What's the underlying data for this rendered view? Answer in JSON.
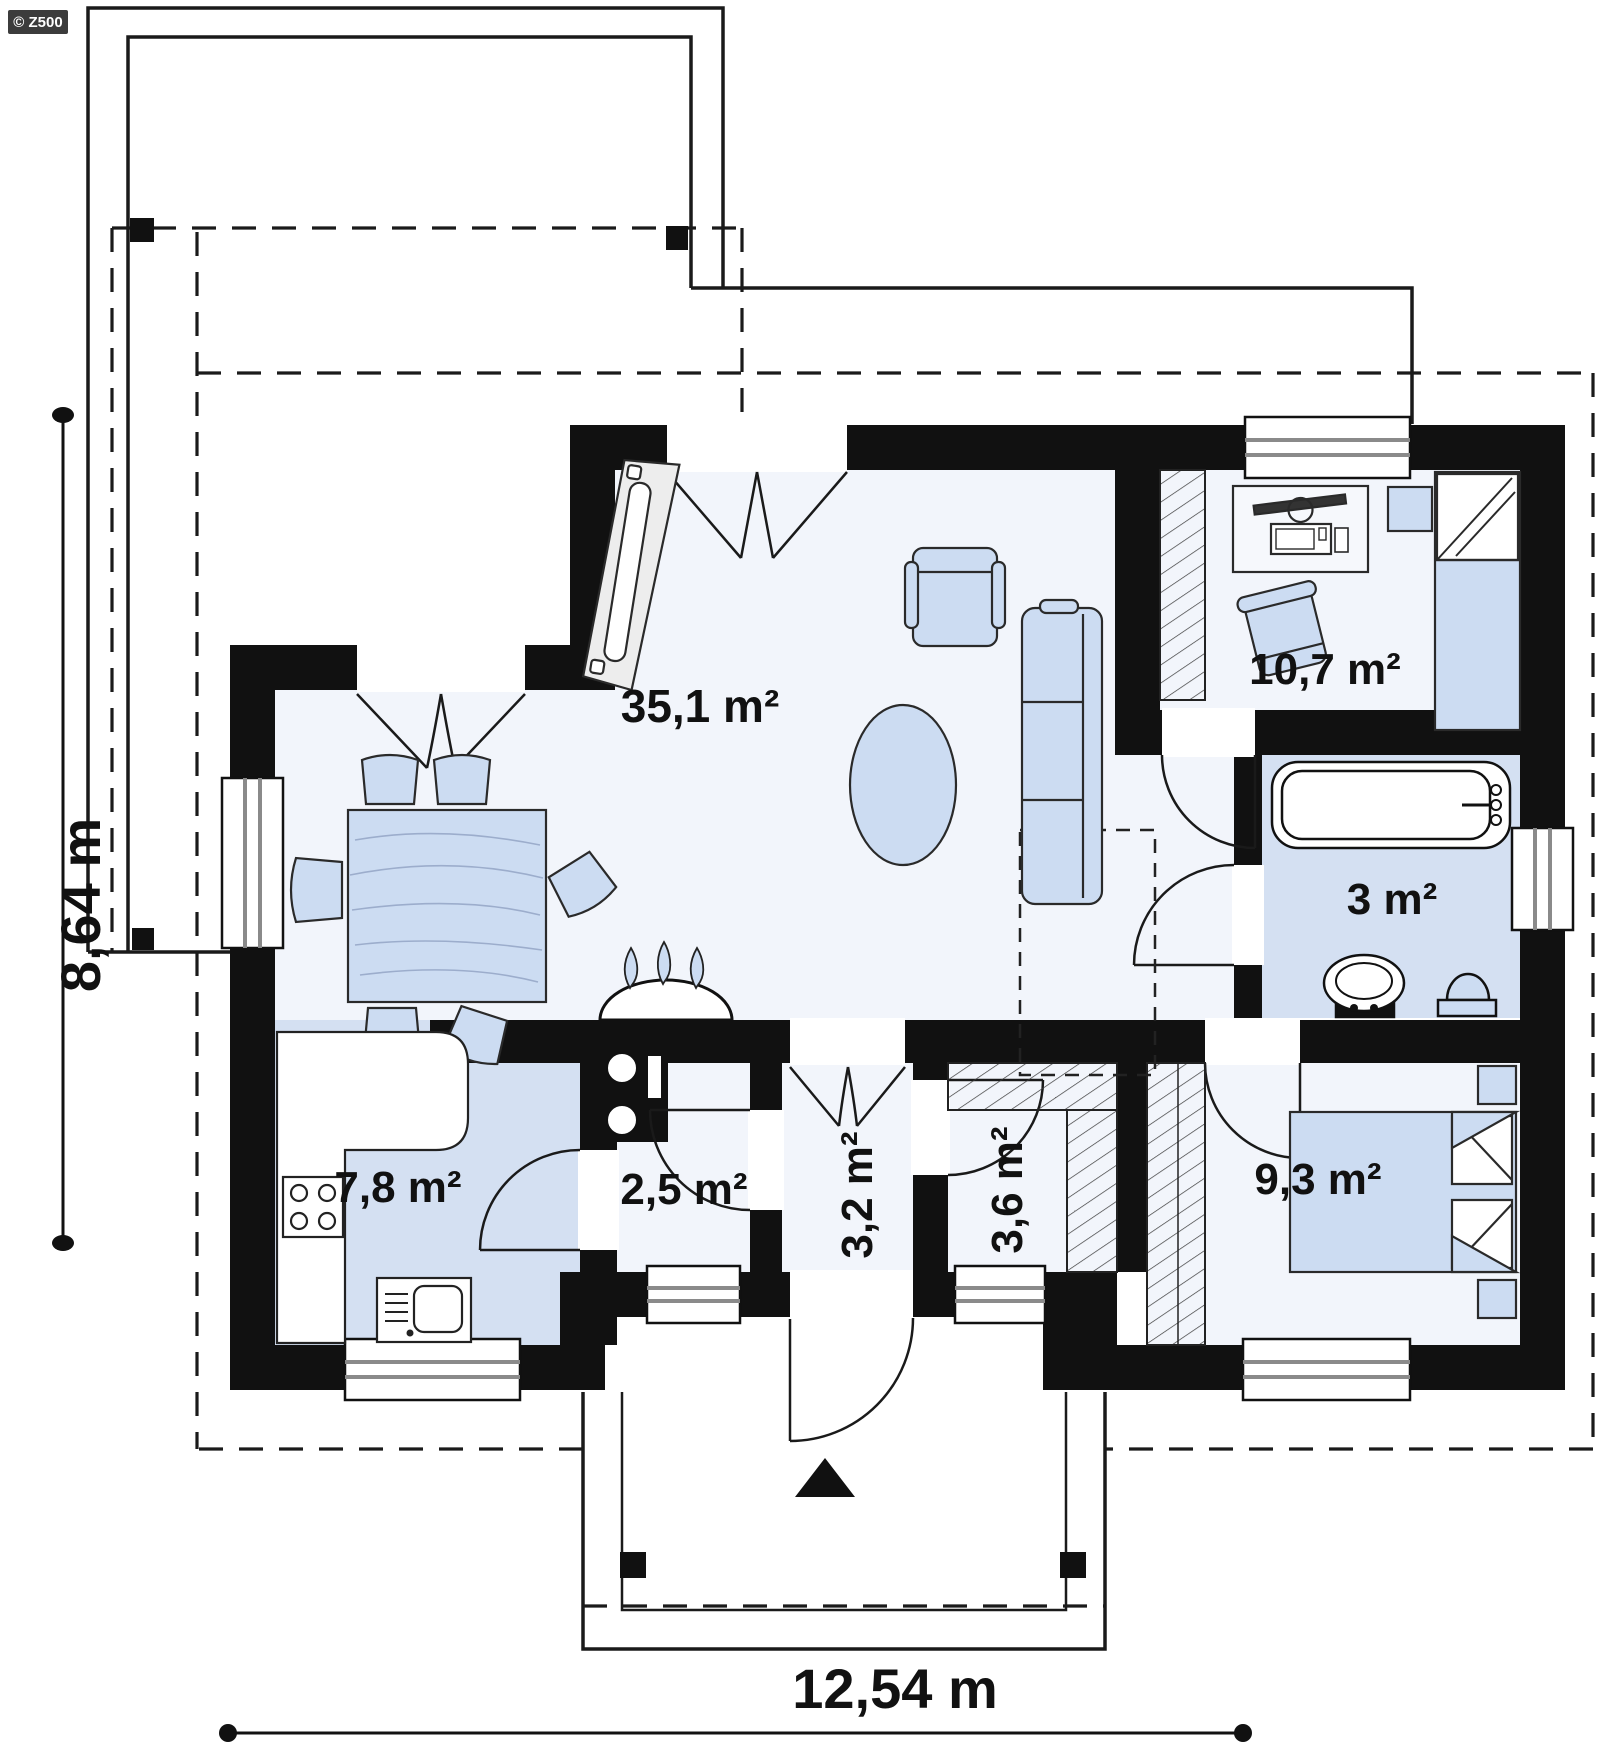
{
  "logo": {
    "text": "© Z500"
  },
  "rooms": {
    "living": {
      "label": "35,1 m²"
    },
    "bedroom_top": {
      "label": "10,7 m²"
    },
    "bathroom": {
      "label": "3 m²"
    },
    "kitchen": {
      "label": "7,8 m²"
    },
    "utility": {
      "label": "2,5 m²"
    },
    "hallway": {
      "label": "3,2 m²"
    },
    "wardrobe": {
      "label": "3,6 m²"
    },
    "bedroom_bottom": {
      "label": "9,3 m²"
    }
  },
  "dimensions": {
    "width_label": "12,54 m",
    "height_label": "8,64 m"
  },
  "colors": {
    "wall": "#111111",
    "floor_light": "#f2f5fb",
    "floor_blue": "#d4e0f2",
    "furniture": "#ccdcf2",
    "line": "#1a1a1a"
  }
}
